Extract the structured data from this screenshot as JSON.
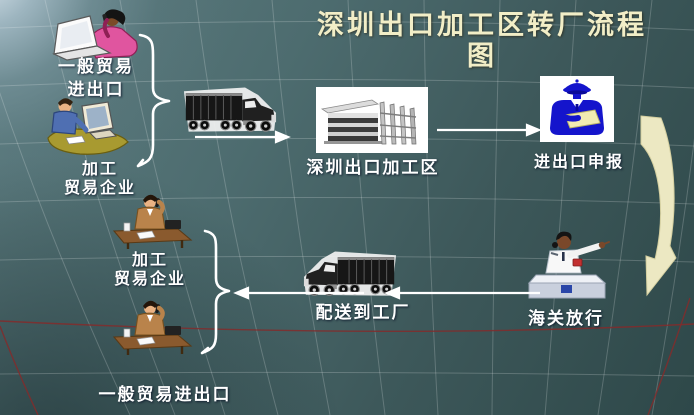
{
  "title": {
    "line1": "深圳出口加工区转厂流程",
    "line2": "图"
  },
  "nodes": {
    "general_trade_top": {
      "line1": "一般贸易",
      "line2": "进出口",
      "icon": "woman-phone-laptop"
    },
    "processing_enterprise_top": {
      "line1": "加工",
      "line2": "贸易企业",
      "icon": "man-at-computer"
    },
    "processing_zone": {
      "label": "深圳出口加工区",
      "icon": "factory-building"
    },
    "customs_declare": {
      "label": "进出口申报",
      "icon": "customs-officer"
    },
    "customs_release": {
      "label": "海关放行",
      "icon": "customs-officer-desk"
    },
    "delivery": {
      "label": "配送到工厂",
      "icon": "truck-left"
    },
    "processing_enterprise_bottom": {
      "line1": "加工",
      "line2": "贸易企业",
      "icon": "man-at-desk-phone"
    },
    "general_trade_bottom": {
      "label": "一般贸易进出口",
      "icon": "man-at-desk-phone"
    }
  },
  "colors": {
    "title_text": "#f2eec7",
    "label_text": "#ffffff",
    "arrow": "#ffffff",
    "curved_arrow": "#ece8c2",
    "officer_blue": "#1414cc",
    "background_light": "#aec4d0",
    "background_dark": "#2e4849",
    "red_gridline": "#6e2828"
  }
}
